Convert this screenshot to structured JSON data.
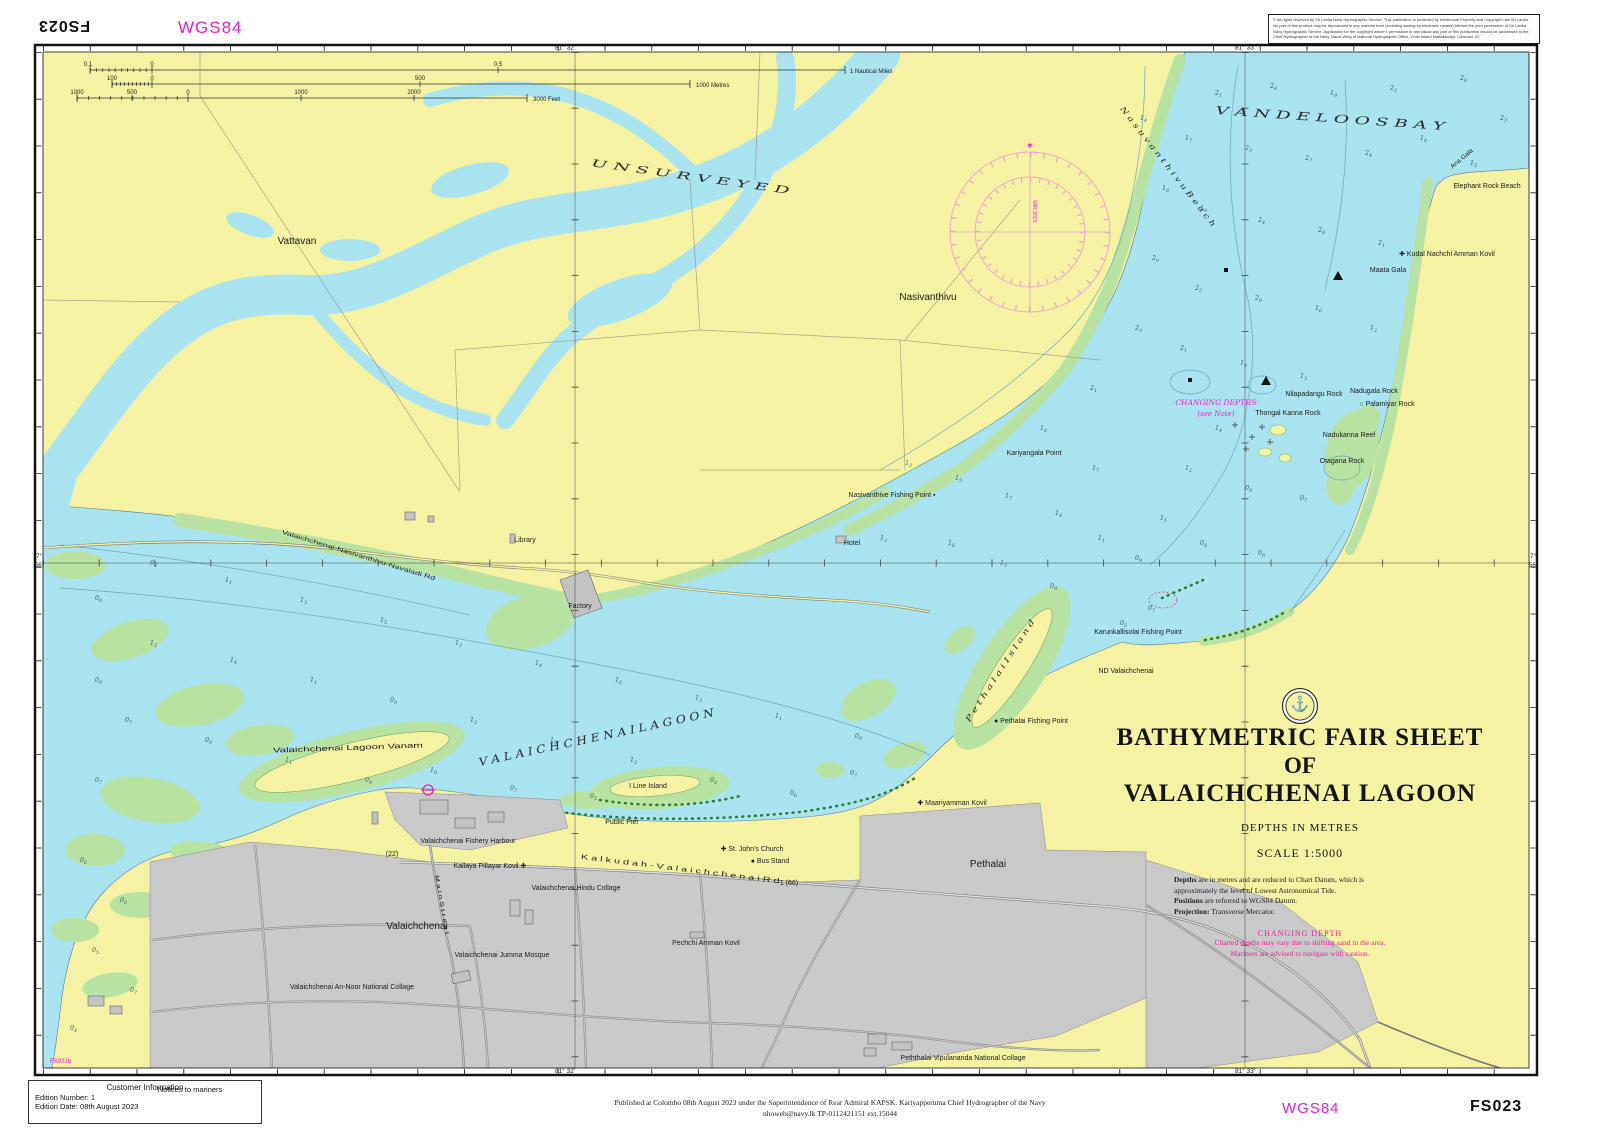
{
  "sheet": {
    "id": "FS023",
    "id_top_mirrored": "FS023",
    "datum_label_top": "WGS84",
    "datum_label_bottom": "WGS84",
    "adjoining_sheet": "FS023b"
  },
  "colors": {
    "water": "#a9e4f0",
    "land": "#f5f3a3",
    "vegetation": "#b8e3a2",
    "urban": "#c9c9c9",
    "magenta": "#e322c6",
    "compass_rose": "#ef9fce",
    "contour": "#6fa8bd"
  },
  "copyright": {
    "lines": [
      "© All rights reserved by Sri Lanka Navy Hydrographic Service. This publication is protected by Intellectual Property and Copyright Law Sri",
      "Lanka. No part of this product may be reproduced in any material form (including storing by electronic means) without the prior permission",
      "of Sri Lanka Navy Hydrographic Service. Application for the copyright owner's permission to reproduce any part of this publication should be",
      "addressed to the Chief Hydrographer of the Navy, Naval Wing of National Hydrographic Office, Crow Island Mattakkuliya, Colombo 15."
    ]
  },
  "customer_info": {
    "title": "Customer Information",
    "edition_number": "Edition Number:  1",
    "edition_date": "Edition Date:  08th August  2023"
  },
  "notices_to_mariners": "Notices to mariners",
  "publication": {
    "line1": "Published at Colombo 08th August 2023 under the Superintendence of Rear Admiral KAPSK. Kariyapperuma Chief Hydrographer of the Navy",
    "line2": "nhoweb@navy.lk TP-0112421151 ext.15044"
  },
  "title_block": {
    "emblem": "anchor-emblem",
    "line1": "BATHYMETRIC FAIR SHEET",
    "line2": "OF",
    "line3": "VALAICHCHENAI LAGOON",
    "depths": "DEPTHS IN METRES",
    "scale": "SCALE 1:5000",
    "notes": [
      {
        "lead": "Depths",
        "rest": " are in metres and are reduced to Chart Datum, which is"
      },
      {
        "lead": "",
        "rest": "approximately the level of Lowest Astronomical Tide."
      },
      {
        "lead": "Positions",
        "rest": " are referred to WGS84 Datum."
      },
      {
        "lead": "Projection:",
        "rest": " Transverse Mercator."
      }
    ],
    "warning_title": "CHANGING DEPTH",
    "warning_lines": [
      "Charted depths may vary due to shifting sand in the area.",
      "Mariners are advised to navigate with caution."
    ]
  },
  "compass": {
    "variation_text": "VAR 2023",
    "north_star": "✶"
  },
  "map_labels": [
    {
      "name": "label-vattavan",
      "text": "Vattavan",
      "x": 297,
      "y": 244,
      "size": 10
    },
    {
      "name": "label-unsurveyed",
      "text": "U N S U R V E Y E D",
      "x": 690,
      "y": 180,
      "size": 10,
      "rot": 8,
      "cls": "serif-it",
      "tl": 200
    },
    {
      "name": "label-nasivanthivu",
      "text": "Nasivanthivu",
      "x": 928,
      "y": 300,
      "size": 10
    },
    {
      "name": "label-vandeloos-bay",
      "text": "V A N D E L O O S   B A Y",
      "x": 1330,
      "y": 122,
      "size": 11,
      "rot": 4,
      "cls": "serif-it",
      "tl": 230
    },
    {
      "name": "label-nasuvanthivu-beach",
      "text": "N a s u v a n t h i v u   B e a c h",
      "x": 1166,
      "y": 168,
      "size": 7.5,
      "rot": 52,
      "cls": "serif-it",
      "tl": 150
    },
    {
      "name": "label-elephant-rock-beach",
      "text": "Elephant Rock Beach",
      "x": 1487,
      "y": 188,
      "size": 7
    },
    {
      "name": "label-ana-gala",
      "text": "Ana Gala",
      "x": 1463,
      "y": 160,
      "size": 6.5,
      "rot": -40
    },
    {
      "name": "label-kudal-nachchi-amman-kovil",
      "text": "✚ Kudal Nachchi Amman Kovil",
      "x": 1447,
      "y": 256,
      "size": 7
    },
    {
      "name": "label-maata-gala",
      "text": "Maata Gala",
      "x": 1388,
      "y": 272,
      "size": 7
    },
    {
      "name": "label-nilapadangu-rock",
      "text": "Nilapadangu Rock",
      "x": 1314,
      "y": 396,
      "size": 7
    },
    {
      "name": "label-nadugala-rock",
      "text": "Nadugala Rock",
      "x": 1374,
      "y": 393,
      "size": 7
    },
    {
      "name": "label-palamiyar-rock",
      "text": "○ Palamiyar Rock",
      "x": 1387,
      "y": 406,
      "size": 7
    },
    {
      "name": "label-thongal-kanna-rock",
      "text": "Thongal Kanna Rock",
      "x": 1288,
      "y": 415,
      "size": 7
    },
    {
      "name": "label-nadukanna-reef",
      "text": "Nadukanna Reef",
      "x": 1349,
      "y": 437,
      "size": 7
    },
    {
      "name": "label-otagana-rock",
      "text": "Otagana Rock",
      "x": 1342,
      "y": 463,
      "size": 7
    },
    {
      "name": "label-changing-depths",
      "text": "CHANGING DEPTHS",
      "x": 1216,
      "y": 405,
      "size": 7.5,
      "cls": "serif-it magenta"
    },
    {
      "name": "label-changing-depths-note",
      "text": "(see Note)",
      "x": 1216,
      "y": 416,
      "size": 7,
      "cls": "serif-it magenta"
    },
    {
      "name": "label-kariyangala-point",
      "text": "Kariyangala Point",
      "x": 1034,
      "y": 455,
      "size": 7
    },
    {
      "name": "label-nasivanthive-fishing-point",
      "text": "Nasivanthive Fishing Point ▪",
      "x": 892,
      "y": 497,
      "size": 7
    },
    {
      "name": "label-library",
      "text": "Library",
      "x": 525,
      "y": 542,
      "size": 7
    },
    {
      "name": "label-hotel",
      "text": "Hotel",
      "x": 852,
      "y": 545,
      "size": 7
    },
    {
      "name": "label-factory",
      "text": "Factory",
      "x": 580,
      "y": 608,
      "size": 7
    },
    {
      "name": "label-road-nasivanthivu",
      "text": "Valaichchenai-Nasivanthivu-Navaladi Rd",
      "x": 358,
      "y": 557,
      "size": 6,
      "rot": 17,
      "tl": 160
    },
    {
      "name": "label-karunkallisolai-fishing-point",
      "text": "Karunkallisolai Fishing Point",
      "x": 1138,
      "y": 634,
      "size": 7
    },
    {
      "name": "label-nd-valaichchenai",
      "text": "ND Valaichchenai",
      "x": 1126,
      "y": 673,
      "size": 7
    },
    {
      "name": "label-pethalai-island",
      "text": "P e t h a l a i   I s l a n d",
      "x": 1002,
      "y": 672,
      "size": 7.5,
      "rot": -57,
      "cls": "serif-it",
      "tl": 120
    },
    {
      "name": "label-pethalai-fishing-point",
      "text": "● Pethalai Fishing Point",
      "x": 1031,
      "y": 723,
      "size": 7
    },
    {
      "name": "label-valaichchenai-lagoon",
      "text": "V A L A I C H C H E N A I   L A G O O N",
      "x": 597,
      "y": 741,
      "size": 11,
      "rot": -12,
      "cls": "serif-it",
      "tl": 240
    },
    {
      "name": "label-lagoon-vanam",
      "text": "Valaichchenai  Lagoon  Vanam",
      "x": 348,
      "y": 750,
      "size": 7,
      "rot": -2,
      "tl": 150
    },
    {
      "name": "label-i-line-island",
      "text": "I Line Island",
      "x": 648,
      "y": 788,
      "size": 7
    },
    {
      "name": "label-public-pier",
      "text": "Public Pier",
      "x": 622,
      "y": 824,
      "size": 7
    },
    {
      "name": "label-fishery-harbour",
      "text": "Valaichchenai Fishery Harbour",
      "x": 468,
      "y": 843,
      "size": 7
    },
    {
      "name": "label-milepost-22",
      "text": "(22)",
      "x": 392,
      "y": 856,
      "size": 7
    },
    {
      "name": "label-kallaya-pillayar-kovil",
      "text": "Kallaya Pillayar Kovil ✚",
      "x": 490,
      "y": 868,
      "size": 7
    },
    {
      "name": "label-kalkudah-valaichchenai-rd",
      "text": "K a l k u d a h  -  V a l a i c h c h e n a i   R d",
      "x": 680,
      "y": 871,
      "size": 7,
      "rot": 7,
      "tl": 200
    },
    {
      "name": "label-st-johns-church",
      "text": "✚ St. John's Church",
      "x": 752,
      "y": 851,
      "size": 7
    },
    {
      "name": "label-bus-stand",
      "text": "● Bus Stand",
      "x": 770,
      "y": 863,
      "size": 7
    },
    {
      "name": "label-hindu-collage",
      "text": "Valaichchenai Hindu Collage",
      "x": 576,
      "y": 890,
      "size": 7
    },
    {
      "name": "label-milepost-66",
      "text": "1 (66)",
      "x": 789,
      "y": 885,
      "size": 7
    },
    {
      "name": "label-valaichchenai-town",
      "text": "Valaichchenai",
      "x": 417,
      "y": 929,
      "size": 10
    },
    {
      "name": "label-pechchi-amman-kovil",
      "text": "Pechchi Amman Kovil",
      "x": 706,
      "y": 945,
      "size": 7
    },
    {
      "name": "label-jumma-mosque",
      "text": "Valaichchenai Jumma Mosque",
      "x": 502,
      "y": 957,
      "size": 7
    },
    {
      "name": "label-an-noor-collage",
      "text": "Valaichchenai An-Noor National Collage",
      "x": 352,
      "y": 989,
      "size": 7
    },
    {
      "name": "label-vipulananda-collage",
      "text": "Peththalai Vipulananda National Collage",
      "x": 963,
      "y": 1060,
      "size": 7
    },
    {
      "name": "label-pethalai-town",
      "text": "Pethalai",
      "x": 988,
      "y": 867,
      "size": 10
    },
    {
      "name": "label-maariyamman-kovil",
      "text": "✚ Maariyamman Kovil",
      "x": 952,
      "y": 805,
      "size": 7
    },
    {
      "name": "label-main-street",
      "text": "M a i n   S t r e e t",
      "x": 440,
      "y": 905,
      "size": 6,
      "rot": 80,
      "tl": 60
    },
    {
      "name": "label-adjoining-sheet",
      "text": "FS023b",
      "x": 50,
      "y": 1063,
      "size": 6,
      "cls": "magenta",
      "anchor": "start"
    },
    {
      "name": "grid-label-top-81-32",
      "text": "81° 32'",
      "x": 565,
      "y": 49.5,
      "size": 6.5
    },
    {
      "name": "grid-label-top-81-33",
      "text": "81° 33'",
      "x": 1245,
      "y": 49.5,
      "size": 6.5
    },
    {
      "name": "grid-label-bottom-81-32",
      "text": "81° 32'",
      "x": 565,
      "y": 1073,
      "size": 6.5
    },
    {
      "name": "grid-label-bottom-81-33",
      "text": "81° 33'",
      "x": 1245,
      "y": 1073,
      "size": 6.5
    },
    {
      "name": "grid-label-left-deg",
      "text": "7°",
      "x": 39,
      "y": 558,
      "size": 6
    },
    {
      "name": "grid-label-left-min",
      "text": "56'",
      "x": 39,
      "y": 567,
      "size": 6
    },
    {
      "name": "grid-label-right-deg",
      "text": "7°",
      "x": 1533,
      "y": 558,
      "size": 6
    },
    {
      "name": "grid-label-right-min",
      "text": "56'",
      "x": 1533,
      "y": 567,
      "size": 6
    },
    {
      "name": "scalebar-nm-01",
      "text": "0.1",
      "x": 88,
      "y": 66,
      "size": 6
    },
    {
      "name": "scalebar-nm-0",
      "text": "0",
      "x": 152,
      "y": 66,
      "size": 6
    },
    {
      "name": "scalebar-nm-05",
      "text": "0.5",
      "x": 498,
      "y": 66,
      "size": 6
    },
    {
      "name": "scalebar-nm-1",
      "text": "1 Nautical Miles",
      "x": 850,
      "y": 73,
      "size": 6,
      "anchor": "start"
    },
    {
      "name": "scalebar-m-100",
      "text": "100",
      "x": 112,
      "y": 80,
      "size": 6
    },
    {
      "name": "scalebar-m-0",
      "text": "0",
      "x": 152,
      "y": 80,
      "size": 6
    },
    {
      "name": "scalebar-m-500",
      "text": "500",
      "x": 420,
      "y": 80,
      "size": 6
    },
    {
      "name": "scalebar-m-1000",
      "text": "1000 Metres",
      "x": 696,
      "y": 87,
      "size": 6,
      "anchor": "start"
    },
    {
      "name": "scalebar-ft-1000-left",
      "text": "1000",
      "x": 77,
      "y": 94,
      "size": 6
    },
    {
      "name": "scalebar-ft-500",
      "text": "500",
      "x": 132,
      "y": 94,
      "size": 6
    },
    {
      "name": "scalebar-ft-0",
      "text": "0",
      "x": 188,
      "y": 94,
      "size": 6
    },
    {
      "name": "scalebar-ft-1000",
      "text": "1000",
      "x": 301,
      "y": 94,
      "size": 6
    },
    {
      "name": "scalebar-ft-2000",
      "text": "2000",
      "x": 414,
      "y": 94,
      "size": 6
    },
    {
      "name": "scalebar-ft-3000",
      "text": "3000 Feet",
      "x": 533,
      "y": 101,
      "size": 6,
      "anchor": "start"
    }
  ],
  "soundings": [
    [
      1215,
      95,
      "2.1"
    ],
    [
      1270,
      88,
      "2.4"
    ],
    [
      1330,
      95,
      "1.9"
    ],
    [
      1390,
      90,
      "2.2"
    ],
    [
      1460,
      80,
      "2.6"
    ],
    [
      1500,
      120,
      "2.3"
    ],
    [
      1185,
      140,
      "1.7"
    ],
    [
      1245,
      150,
      "2.3"
    ],
    [
      1305,
      160,
      "2.7"
    ],
    [
      1365,
      155,
      "2.4"
    ],
    [
      1420,
      140,
      "1.8"
    ],
    [
      1470,
      165,
      "1.5"
    ],
    [
      1200,
      210,
      "1.9"
    ],
    [
      1258,
      222,
      "2.4"
    ],
    [
      1318,
      232,
      "2.8"
    ],
    [
      1378,
      245,
      "2.1"
    ],
    [
      1255,
      300,
      "2.6"
    ],
    [
      1195,
      290,
      "2.2"
    ],
    [
      1315,
      310,
      "1.6"
    ],
    [
      1370,
      330,
      "1.2"
    ],
    [
      1180,
      350,
      "2.1"
    ],
    [
      1240,
      365,
      "1.8"
    ],
    [
      1300,
      378,
      "1.3"
    ],
    [
      1215,
      430,
      "1.4"
    ],
    [
      1185,
      470,
      "1.2"
    ],
    [
      1245,
      490,
      "0.9"
    ],
    [
      1300,
      500,
      "0.7"
    ],
    [
      1200,
      545,
      "0.8"
    ],
    [
      1258,
      555,
      "0.6"
    ],
    [
      1160,
      520,
      "1.1"
    ],
    [
      1135,
      560,
      "0.9"
    ],
    [
      905,
      465,
      "1.2"
    ],
    [
      955,
      480,
      "1.5"
    ],
    [
      1005,
      498,
      "1.7"
    ],
    [
      1055,
      515,
      "1.4"
    ],
    [
      1098,
      540,
      "1.1"
    ],
    [
      948,
      545,
      "1.6"
    ],
    [
      1000,
      565,
      "1.3"
    ],
    [
      1050,
      588,
      "0.9"
    ],
    [
      880,
      540,
      "1.3"
    ],
    [
      1092,
      470,
      "1.7"
    ],
    [
      1148,
      610,
      "0.7"
    ],
    [
      1120,
      625,
      "0.5"
    ],
    [
      1040,
      430,
      "1.8"
    ],
    [
      1090,
      390,
      "2.1"
    ],
    [
      1135,
      330,
      "2.3"
    ],
    [
      1152,
      260,
      "2.0"
    ],
    [
      1162,
      190,
      "1.6"
    ],
    [
      1140,
      120,
      "1.4"
    ],
    [
      150,
      565,
      "0.8"
    ],
    [
      225,
      582,
      "1.1"
    ],
    [
      300,
      602,
      "1.3"
    ],
    [
      380,
      622,
      "1.5"
    ],
    [
      455,
      645,
      "1.2"
    ],
    [
      535,
      665,
      "1.4"
    ],
    [
      615,
      682,
      "1.6"
    ],
    [
      695,
      700,
      "1.3"
    ],
    [
      775,
      718,
      "1.1"
    ],
    [
      855,
      738,
      "0.9"
    ],
    [
      150,
      645,
      "1.2"
    ],
    [
      230,
      662,
      "1.4"
    ],
    [
      310,
      682,
      "1.1"
    ],
    [
      390,
      702,
      "0.9"
    ],
    [
      470,
      722,
      "1.2"
    ],
    [
      550,
      742,
      "1.5"
    ],
    [
      630,
      762,
      "1.2"
    ],
    [
      710,
      782,
      "0.8"
    ],
    [
      125,
      722,
      "0.7"
    ],
    [
      205,
      742,
      "0.9"
    ],
    [
      285,
      762,
      "1.1"
    ],
    [
      365,
      782,
      "0.8"
    ],
    [
      95,
      600,
      "0.6"
    ],
    [
      95,
      682,
      "0.9"
    ],
    [
      95,
      782,
      "0.7"
    ],
    [
      430,
      772,
      "1.0"
    ],
    [
      510,
      790,
      "0.7"
    ],
    [
      590,
      798,
      "0.5"
    ],
    [
      850,
      775,
      "0.7"
    ],
    [
      790,
      795,
      "0.6"
    ],
    [
      80,
      862,
      "0.6"
    ],
    [
      120,
      902,
      "0.8"
    ],
    [
      92,
      952,
      "0.5"
    ],
    [
      130,
      992,
      "0.7"
    ],
    [
      70,
      1030,
      "0.4"
    ]
  ]
}
